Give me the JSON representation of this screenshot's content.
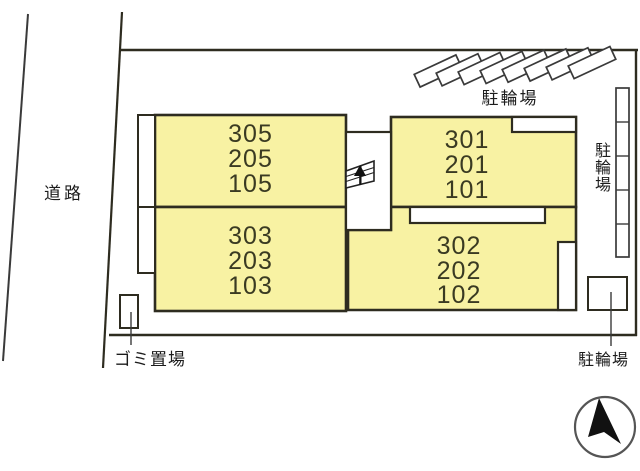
{
  "plan": {
    "title": "building site plan",
    "labels": {
      "road": "道路",
      "bicycle_parking_top": "駐輪場",
      "bicycle_parking_right": "駐輪場",
      "bicycle_parking_bottom": "駐輪場",
      "garbage_area": "ゴミ置場"
    },
    "buildings": {
      "block_a": {
        "units": [
          "305",
          "205",
          "105"
        ]
      },
      "block_b": {
        "units": [
          "303",
          "203",
          "103"
        ]
      },
      "block_c": {
        "units": [
          "301",
          "201",
          "101"
        ]
      },
      "block_d": {
        "units": [
          "302",
          "202",
          "102"
        ]
      }
    },
    "icons": {
      "stairs": "stairs-icon",
      "compass": "north-arrow-icon"
    },
    "colors": {
      "building_fill": "#f8f2a3",
      "outline": "#2e2c20",
      "boundary_line": "#3a3a3a",
      "unit_text": "#3a3a22"
    },
    "counts": {
      "diagonal_bicycle_slots": 8,
      "right_bicycle_rack_cells": 5
    }
  }
}
